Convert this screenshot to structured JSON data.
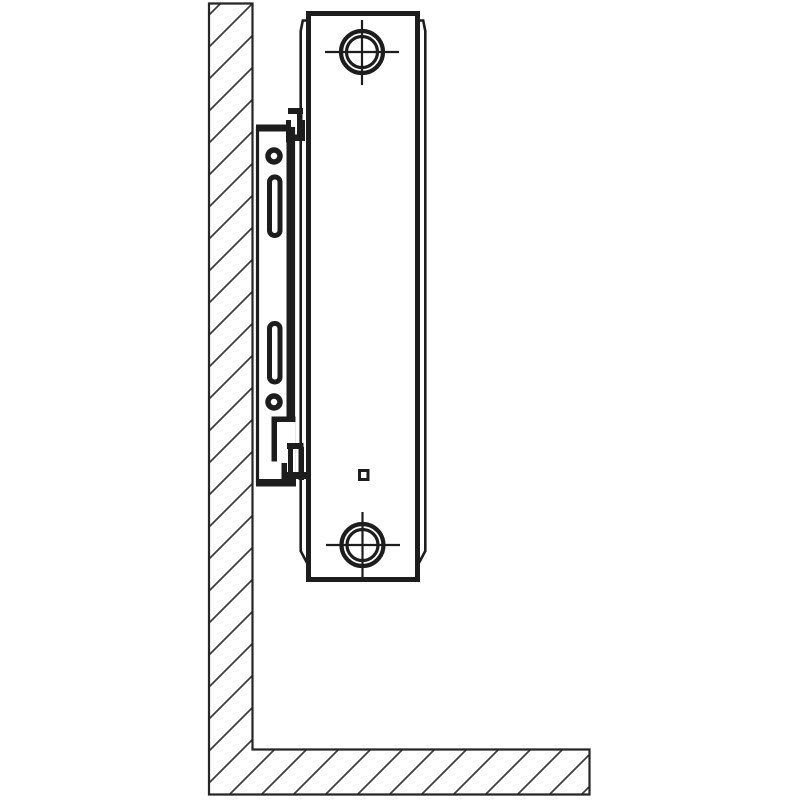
{
  "page": {
    "title": "Panel radiator wall-mounting bracket installation — side view diagram",
    "background": "#ffffff"
  },
  "colors": {
    "line": "#1d1d1d",
    "hatch": "#3c3c3c",
    "structure_outline": "#262626",
    "surface": "#ffffff"
  },
  "diagram": {
    "type": "technical-line-drawing",
    "view": "side-profile-section",
    "text_labels": [],
    "components": [
      {
        "id": "wall",
        "label": "wall-hatched-section"
      },
      {
        "id": "floor",
        "label": "floor-hatched-section"
      },
      {
        "id": "mounting-bracket",
        "label": "wall-bracket-plate"
      },
      {
        "id": "bracket-slot-upper",
        "label": "upper-fixing-slot"
      },
      {
        "id": "bracket-slot-lower",
        "label": "lower-fixing-slot"
      },
      {
        "id": "bracket-hole-upper",
        "label": "upper-screw-hole"
      },
      {
        "id": "bracket-hole-lower",
        "label": "lower-screw-hole"
      },
      {
        "id": "top-clip",
        "label": "upper-retaining-clip"
      },
      {
        "id": "bottom-clip",
        "label": "lower-retaining-clip"
      },
      {
        "id": "radiator-body",
        "label": "panel-radiator-side-view"
      },
      {
        "id": "radiator-front-panel",
        "label": "front-panel-profile-line"
      },
      {
        "id": "radiator-rear-panel",
        "label": "rear-panel-profile-line"
      },
      {
        "id": "top-connection",
        "label": "top-pipe-connection-boss"
      },
      {
        "id": "bottom-connection",
        "label": "bottom-pipe-connection-boss"
      },
      {
        "id": "vent-detail",
        "label": "small-square-panel-detail"
      }
    ],
    "counts": {
      "bracket_slots": 2,
      "bracket_screw_holes": 2,
      "retaining_clips": 2,
      "pipe_connections": 2
    }
  }
}
